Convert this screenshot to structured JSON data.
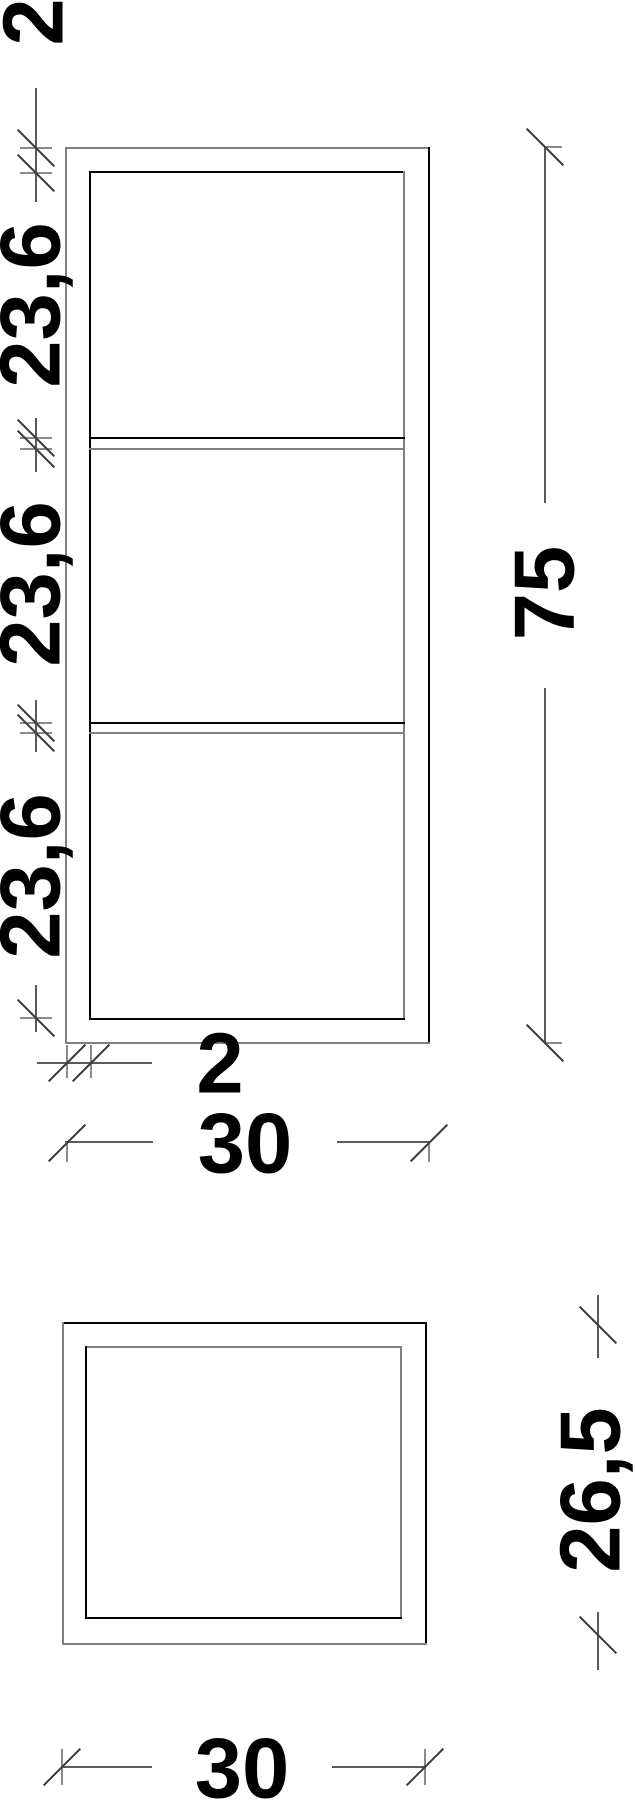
{
  "page": {
    "background": "#ffffff",
    "description": "Technical drawing of a three-compartment wall shelf: front view (top) and top view (bottom), dimensions in cm"
  },
  "front_view": {
    "labels": {
      "top_panel_thickness": "2",
      "compartment_top": "23,6",
      "compartment_middle": "23,6",
      "compartment_bottom": "23,6",
      "overall_height": "75",
      "side_panel_thickness": "2",
      "overall_width": "30"
    }
  },
  "top_view": {
    "labels": {
      "overall_depth": "26,5",
      "overall_width": "30"
    }
  },
  "dimensions_cm": {
    "front": {
      "overall_width": 30,
      "overall_height": 75,
      "top_panel_thickness": 2,
      "side_panel_thickness": 2,
      "compartment_heights": [
        23.6,
        23.6,
        23.6
      ]
    },
    "top": {
      "overall_width": 30,
      "overall_depth": 26.5
    }
  },
  "colors": {
    "object_line_dark": "#000000",
    "object_line_gray": "#808080",
    "dimension_line": "#5a5a5a",
    "tick": "#3c3c3c",
    "extension_line": "#8a8a8a",
    "text": "#000000"
  }
}
